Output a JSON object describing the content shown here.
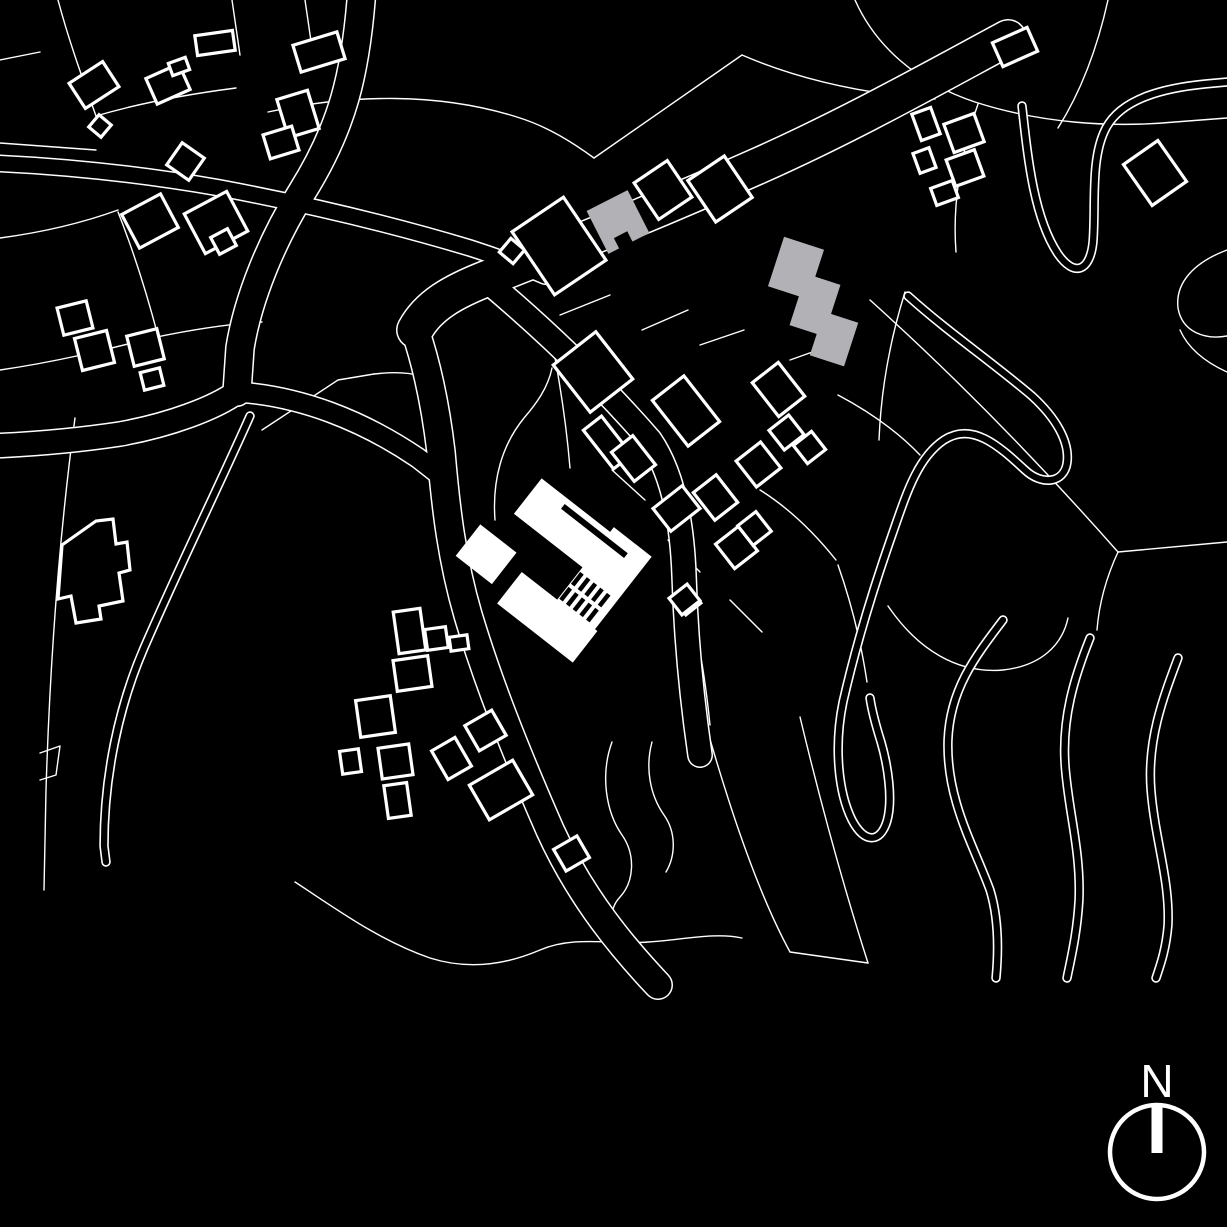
{
  "meta": {
    "map_type": "figure-ground architectural site plan",
    "colors": {
      "bg": "#000000",
      "line": "#ffffff",
      "building_fill": "#000000",
      "featured_fill": "#ffffff",
      "gray_fill": "#b2b2b6"
    }
  },
  "north_arrow": {
    "label": "N",
    "cx": 1157,
    "cy": 1152,
    "r": 47,
    "ring_stroke": 4.5,
    "bar": {
      "x": 1151.5,
      "y": 1104,
      "w": 11,
      "h": 49
    },
    "label_x": 1157,
    "label_y": 1097,
    "font_size": 46
  },
  "map": {
    "viewbox": "0 0 1227 1227",
    "parcel_stroke": 1.4,
    "building_stroke": 3.2,
    "parcels": [
      "M 58,0 C 70,45 85,85 96,116",
      "M 96,116 C 150,100 205,92 236,88",
      "M 0,143 L 96,150",
      "M 0,238 C 45,232 85,222 118,210",
      "M 118,212 C 135,255 148,298 158,336",
      "M 0,370 C 55,362 105,350 152,338",
      "M 152,338 C 190,330 228,324 262,322",
      "M 232,0 L 240,55",
      "M 305,0 L 312,48",
      "M 268,112 C 350,94 440,92 520,118 C 548,127 572,142 594,158",
      "M 594,158 L 742,55",
      "M 742,55 C 800,80 865,94 935,99",
      "M 855,0 C 875,45 915,82 975,102 C 1040,123 1110,128 1175,122 L 1227,118",
      "M 978,104 C 962,150 952,200 956,252",
      "M 1108,0 C 1098,45 1082,90 1058,128",
      "M 870,300 C 950,372 1035,458 1118,552 L 1227,542",
      "M 1118,552 C 1106,578 1099,604 1097,630",
      "M 262,430 L 338,380 L 374,374",
      "M 374,374 C 392,372 408,372 420,376",
      "M 548,322 C 558,370 566,420 570,468",
      "M 495,520 C 492,480 502,445 524,418 C 536,404 548,388 552,368",
      "M 560,315 L 610,295",
      "M 642,330 L 688,310",
      "M 700,345 L 744,330",
      "M 790,360 L 832,345",
      "M 838,395 C 870,412 898,432 920,455",
      "M 612,470 L 645,500",
      "M 668,540 L 700,572",
      "M 730,600 L 762,632",
      "M 640,430 L 662,455",
      "M 760,490 C 792,510 816,535 836,560",
      "M 905,292 C 890,340 881,390 879,440",
      "M 838,565 C 851,602 861,642 867,682",
      "M 690,605 C 700,645 706,685 710,725",
      "M 295,882 C 335,908 378,940 430,958 C 468,970 505,965 540,950 C 575,935 612,945 648,942 C 682,940 714,932 742,938",
      "M 700,705 C 722,782 752,882 790,952 L 868,963",
      "M 868,963 C 842,882 818,792 800,717",
      "M 612,742 C 600,775 606,812 622,835 C 636,855 634,882 620,897 C 608,910 610,928 622,940",
      "M 652,742 C 645,768 650,795 664,815 C 676,832 676,855 666,872",
      "M 40,753 L 60,746 L 56,775 L 40,780",
      "M 75,418 C 60,530 50,660 46,790 L 44,890",
      "M 888,606 C 918,650 958,674 1003,670 C 1040,666 1062,646 1068,618",
      "M 1227,250 C 1195,262 1175,282 1178,308 C 1182,332 1205,340 1227,336",
      "M 1227,372 C 1205,362 1188,348 1180,330",
      "M 0,60 L 40,52"
    ],
    "roads": [
      {
        "d": "M 362,-12 C 356,75 342,128 302,192 C 272,240 248,298 240,348 L 237,392",
        "w": 30
      },
      {
        "d": "M 237,392 C 215,408 170,425 120,434 C 80,440 40,444 -10,446",
        "w": 26
      },
      {
        "d": "M -10,163 C 60,166 140,174 220,188 C 300,203 390,224 470,248 C 498,257 522,266 545,276",
        "w": 18
      },
      {
        "d": "M 1008,38 C 930,80 848,126 758,166 C 668,206 565,248 488,278 C 452,292 428,306 415,330",
        "w": 38
      },
      {
        "d": "M 415,330 C 428,368 436,410 441,452 C 446,510 452,560 468,615 C 488,682 515,750 550,830 C 582,900 625,950 658,985",
        "w": 30
      },
      {
        "d": "M 237,392 C 300,396 362,420 418,458 L 441,476",
        "w": 22
      },
      {
        "d": "M 488,282 C 545,330 602,385 650,440 C 672,472 682,520 684,575 C 686,640 692,700 700,755",
        "w": 26
      }
    ],
    "tracks": [
      {
        "d": "M 250,416 C 218,488 180,565 144,648 C 118,708 104,778 104,846 L 106,862",
        "w": 9.5
      },
      {
        "d": "M 1022,106 C 1028,160 1034,218 1058,254 C 1074,277 1090,272 1093,242 C 1096,205 1090,158 1106,128 C 1122,98 1165,88 1205,84 L 1227,82",
        "w": 9.5
      },
      {
        "d": "M 908,296 C 948,332 992,362 1032,396 C 1056,418 1070,442 1067,463 C 1064,483 1042,486 1025,470 C 998,445 972,422 944,440 C 917,458 906,495 892,535 C 872,592 856,645 843,702 C 834,746 838,792 852,820 C 864,843 880,844 887,821 C 893,800 888,766 881,742 C 876,726 872,712 870,698",
        "w": 9.5
      },
      {
        "d": "M 1003,620 C 974,658 950,690 948,740 C 946,800 974,846 990,890 C 998,916 999,946 996,978",
        "w": 9.5
      },
      {
        "d": "M 1090,638 C 1074,678 1062,718 1065,764 C 1068,810 1081,850 1079,900 C 1077,934 1071,958 1067,978",
        "w": 9.5
      },
      {
        "d": "M 1178,658 C 1163,698 1147,740 1151,790 C 1155,840 1170,880 1168,925 C 1166,950 1160,966 1156,978",
        "w": 9.5
      }
    ],
    "buildings": [
      [
        74,
        70,
        40,
        30,
        -33
      ],
      [
        150,
        70,
        36,
        28,
        -24
      ],
      [
        92,
        118,
        16,
        16,
        40
      ],
      [
        196,
        33,
        38,
        20,
        -8
      ],
      [
        170,
        60,
        18,
        13,
        -20
      ],
      [
        296,
        38,
        46,
        28,
        -17
      ],
      [
        282,
        94,
        32,
        40,
        -17
      ],
      [
        266,
        130,
        30,
        25,
        -17
      ],
      [
        172,
        148,
        27,
        27,
        35
      ],
      [
        128,
        202,
        44,
        38,
        -28
      ],
      [
        192,
        200,
        48,
        45,
        -28
      ],
      [
        214,
        232,
        19,
        19,
        -28
      ],
      [
        60,
        304,
        30,
        28,
        -14
      ],
      [
        78,
        334,
        33,
        33,
        -14
      ],
      [
        130,
        332,
        31,
        31,
        -14
      ],
      [
        142,
        370,
        20,
        18,
        -14
      ],
      [
        503,
        242,
        18,
        18,
        40
      ],
      [
        528,
        208,
        62,
        76,
        -34
      ],
      [
        643,
        168,
        40,
        44,
        -34
      ],
      [
        698,
        164,
        44,
        50,
        -34
      ],
      [
        996,
        34,
        38,
        26,
        -24
      ],
      [
        916,
        110,
        20,
        28,
        -20
      ],
      [
        948,
        118,
        32,
        30,
        -20
      ],
      [
        950,
        154,
        30,
        28,
        -20
      ],
      [
        916,
        150,
        17,
        21,
        -20
      ],
      [
        933,
        184,
        23,
        18,
        -20
      ],
      [
        1134,
        148,
        42,
        50,
        -35
      ],
      [
        566,
        342,
        54,
        60,
        -38
      ],
      [
        596,
        418,
        23,
        49,
        -38
      ],
      [
        620,
        440,
        27,
        37,
        -38
      ],
      [
        666,
        382,
        40,
        58,
        -38
      ],
      [
        701,
        480,
        29,
        35,
        -38
      ],
      [
        743,
        448,
        31,
        33,
        -38
      ],
      [
        762,
        368,
        33,
        43,
        -38
      ],
      [
        774,
        420,
        25,
        25,
        -38
      ],
      [
        798,
        436,
        23,
        23,
        -38
      ],
      [
        722,
        532,
        29,
        31,
        -38
      ],
      [
        743,
        516,
        23,
        25,
        -38
      ],
      [
        678,
        592,
        19,
        19,
        -38
      ],
      [
        658,
        494,
        37,
        29,
        -38
      ],
      [
        396,
        610,
        27,
        42,
        -8
      ],
      [
        426,
        628,
        21,
        21,
        -8
      ],
      [
        395,
        658,
        35,
        31,
        -8
      ],
      [
        358,
        698,
        35,
        37,
        -8
      ],
      [
        341,
        750,
        19,
        23,
        -8
      ],
      [
        380,
        746,
        31,
        31,
        -8
      ],
      [
        386,
        784,
        23,
        33,
        -8
      ],
      [
        438,
        742,
        27,
        33,
        -30
      ],
      [
        470,
        716,
        31,
        29,
        -30
      ],
      [
        476,
        770,
        50,
        40,
        -30
      ],
      [
        558,
        841,
        27,
        25,
        -30
      ],
      [
        673,
        589,
        23,
        21,
        -38
      ],
      [
        450,
        636,
        18,
        14,
        -8
      ]
    ],
    "building_polys": [
      "62,545 96,521 113,519 116,544 127,542 130,570 119,573 123,601 99,606 101,619 76,623 71,596 58,599"
    ],
    "gray_small": {
      "rect": [
        595,
        198,
        46,
        48,
        -27
      ],
      "notch": [
        616,
        234,
        15,
        13,
        -27
      ]
    },
    "gray_big": [
      [
        775,
        242,
        42,
        52,
        18
      ],
      [
        797,
        278,
        36,
        54,
        18
      ],
      [
        816,
        316,
        36,
        46,
        18
      ]
    ],
    "main_building": {
      "pivot": [
        555,
        570
      ],
      "angle": 38,
      "rects": [
        [
          488,
          506,
          120,
          45
        ],
        [
          575,
          500,
          48,
          125
        ],
        [
          530,
          592,
          96,
          40
        ],
        [
          468,
          580,
          46,
          40
        ]
      ],
      "slot": [
        522,
        512,
        80,
        6
      ],
      "hatch": {
        "xs": [
          576,
          584.5,
          593,
          601.5,
          610
        ],
        "rows": [
          556,
          575
        ],
        "w": 4.5,
        "h": 15
      }
    }
  }
}
